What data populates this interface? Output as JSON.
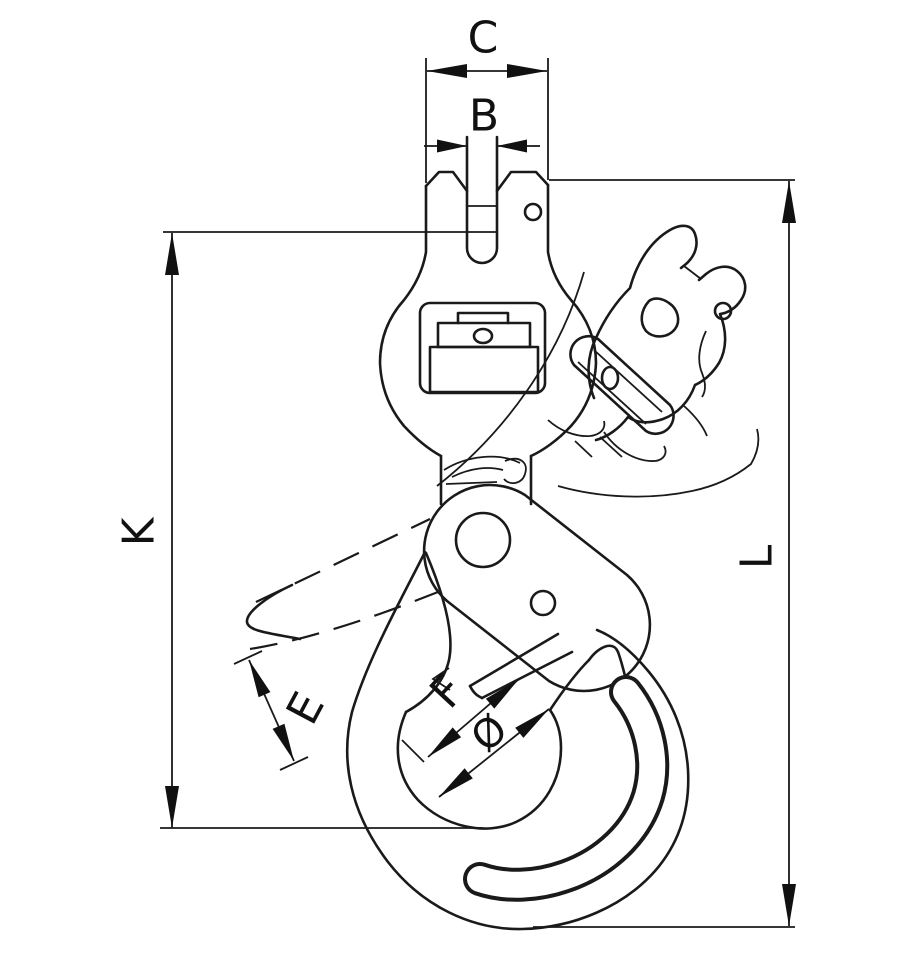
{
  "diagram": {
    "kind": "technical-line-drawing",
    "subject": "swivel self-locking hook with dimension annotations",
    "background_color": "#ffffff",
    "line_color": "#1a1a1a",
    "labels": {
      "c": "C",
      "b": "B",
      "k": "K",
      "l": "L",
      "e": "E",
      "f": "F",
      "q": "Ø"
    },
    "dimension_list": [
      "C",
      "B",
      "K",
      "L",
      "E",
      "F",
      "Ø"
    ]
  }
}
